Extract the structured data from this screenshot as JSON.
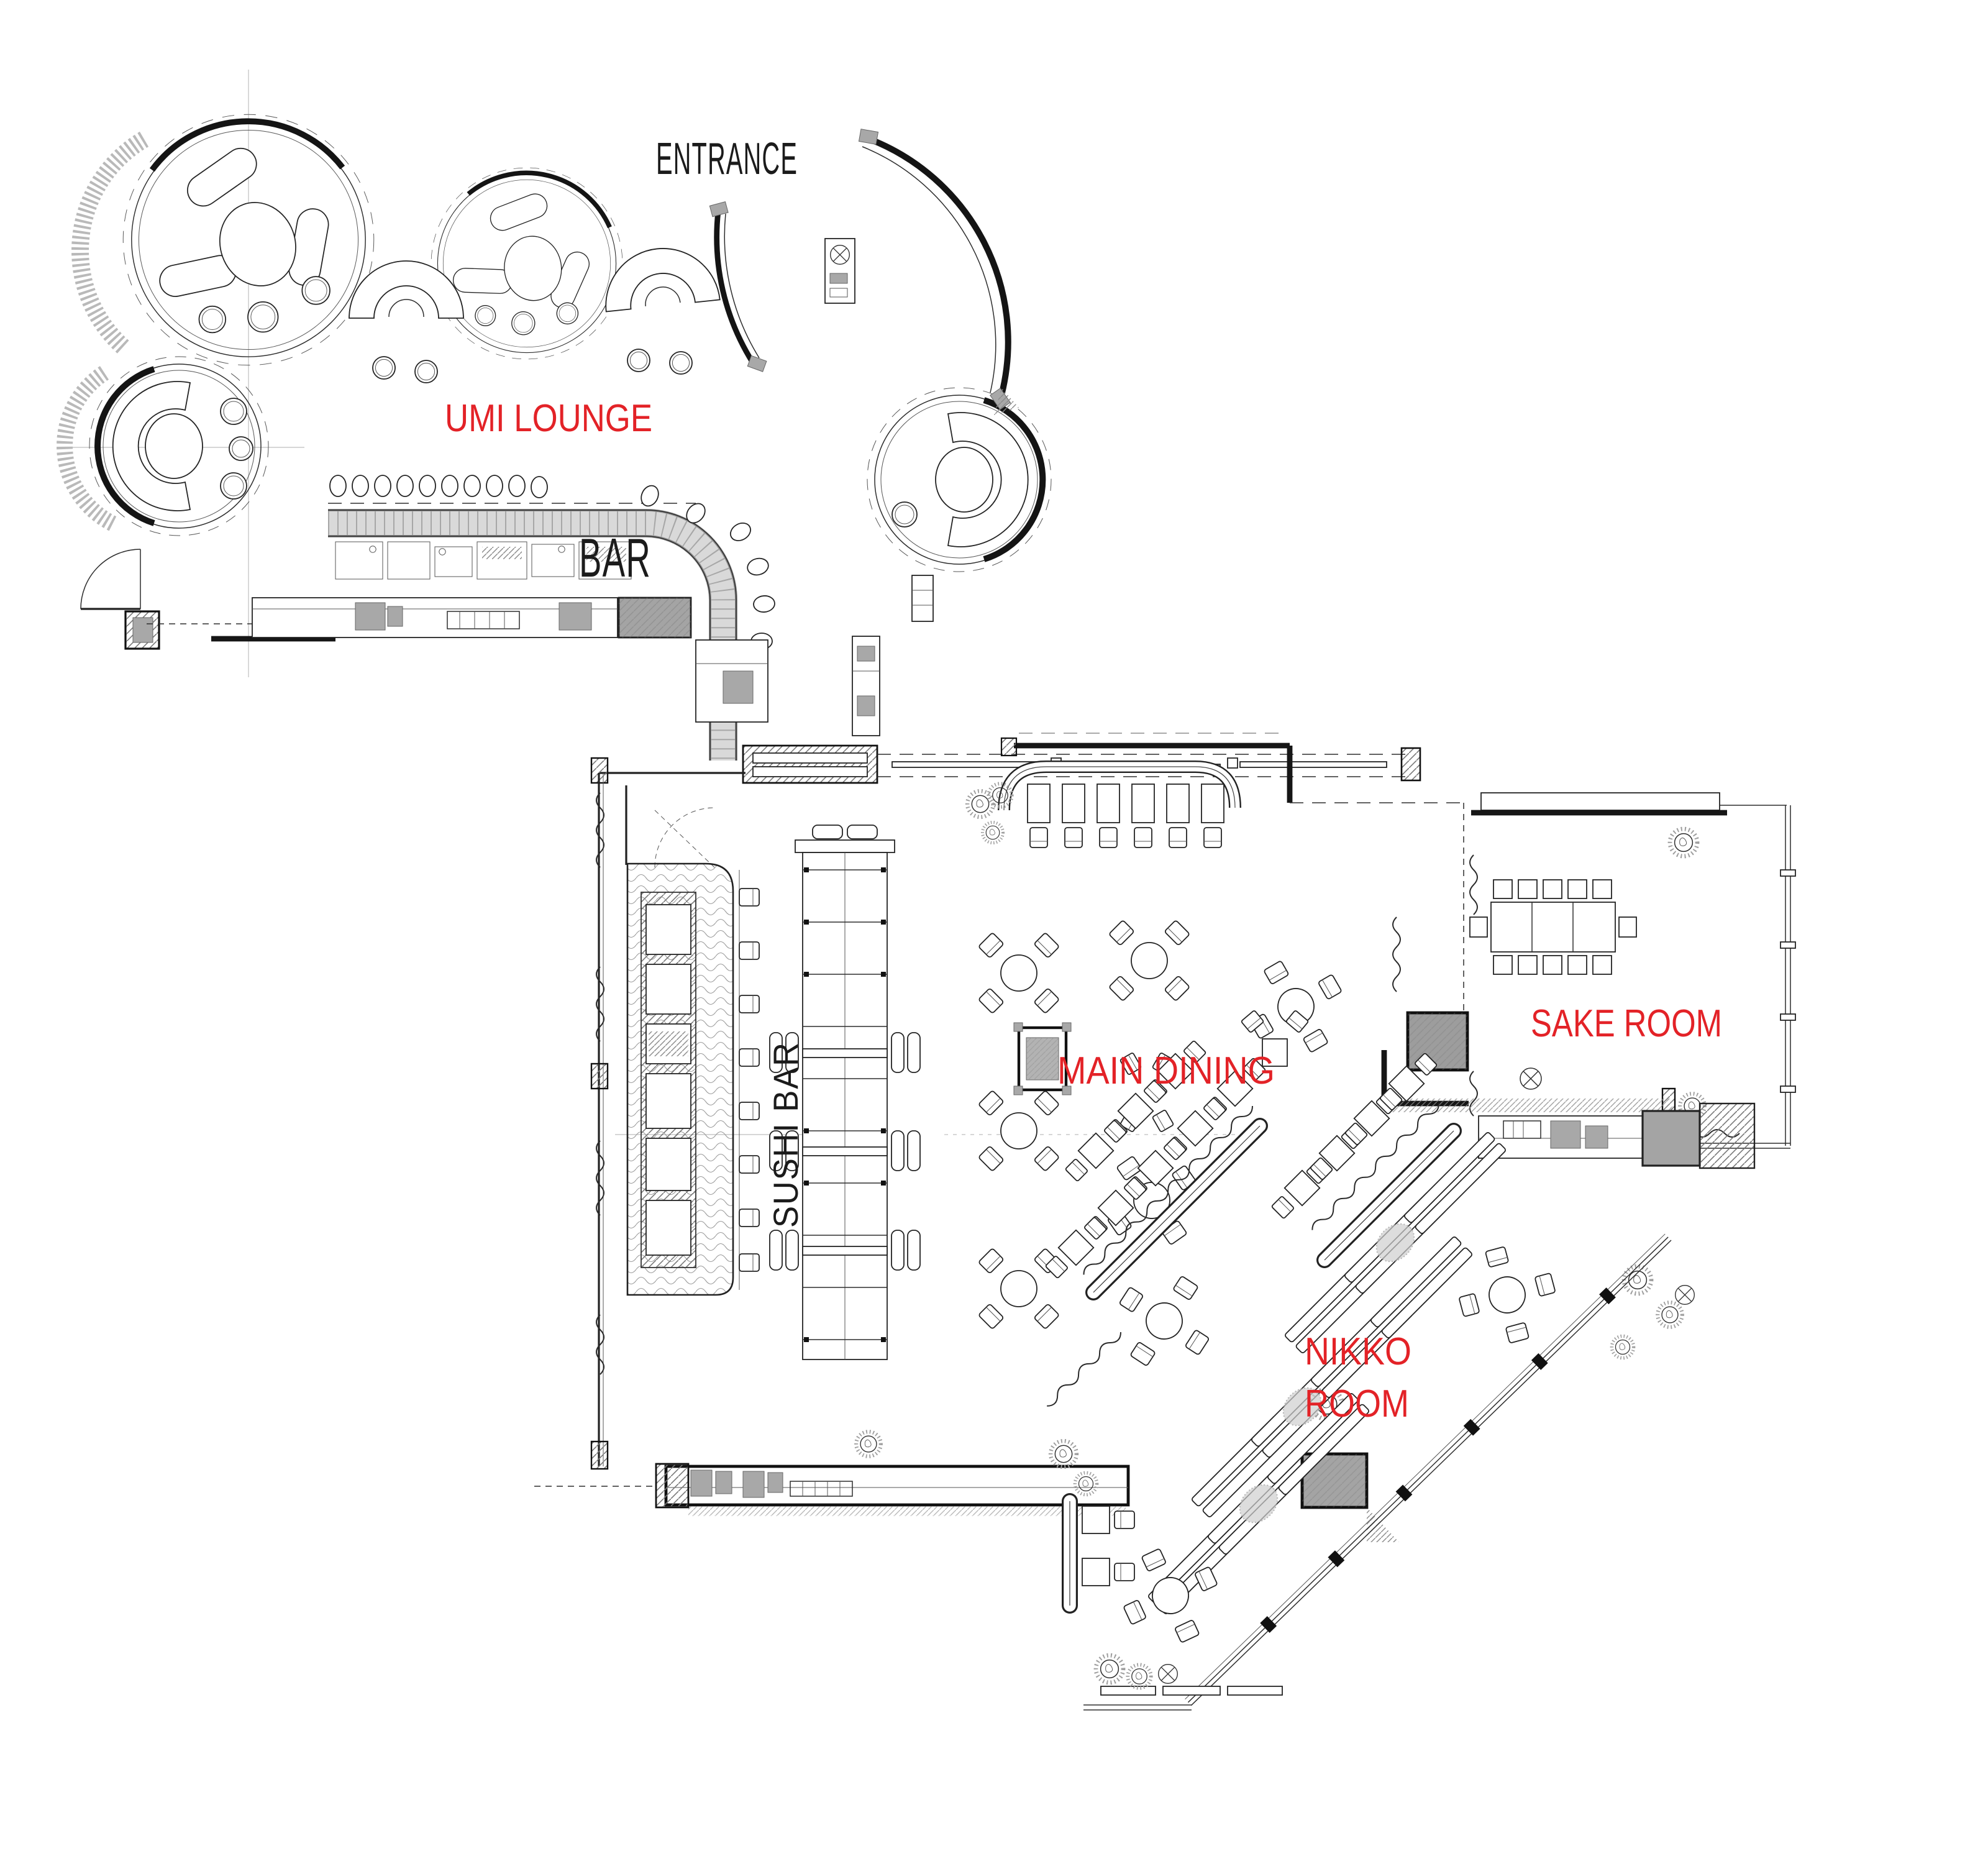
{
  "labels": {
    "entrance": "ENTRANCE",
    "umi_lounge": "UMI LOUNGE",
    "bar": "BAR",
    "sushi_bar": "SUSHI BAR",
    "main_dining": "MAIN DINING",
    "sake_room": "SAKE ROOM",
    "nikko_room_line1": "NIKKO",
    "nikko_room_line2": "ROOM"
  },
  "colors": {
    "room_label": "#e32227",
    "plan_label": "#1b1b1b",
    "background": "#ffffff",
    "stone_fill": "#d6d6d6",
    "equipment_gray": "#a8a8a8"
  }
}
